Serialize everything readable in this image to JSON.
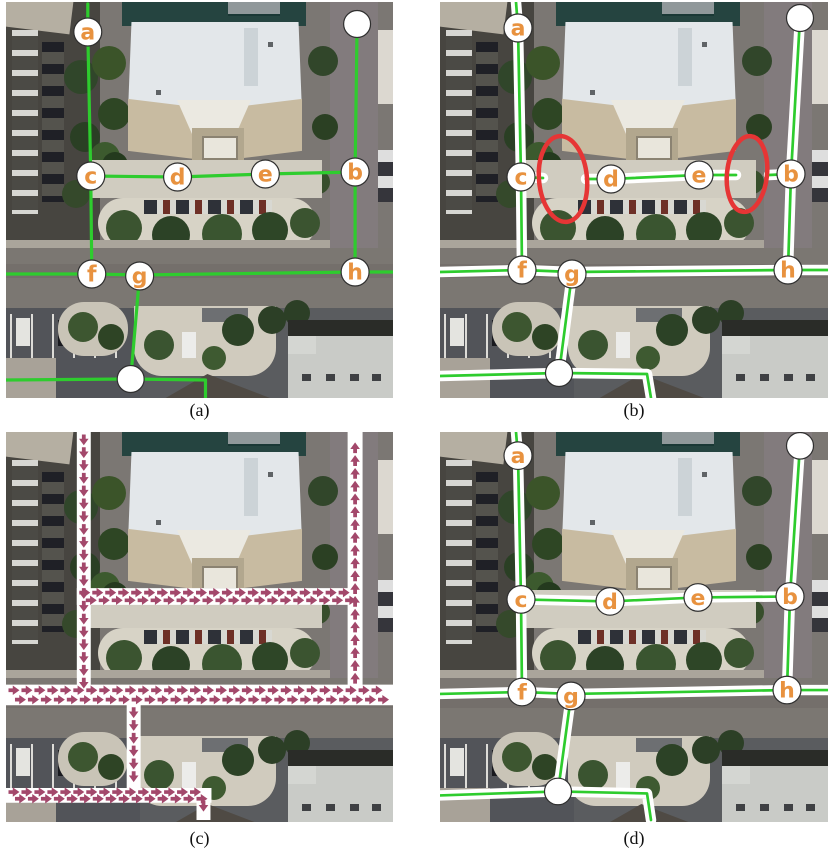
{
  "figure": {
    "background": "#ffffff",
    "panels": [
      {
        "id": "a",
        "caption": "(a)"
      },
      {
        "id": "b",
        "caption": "(b)"
      },
      {
        "id": "c",
        "caption": "(c)"
      },
      {
        "id": "d",
        "caption": "(d)"
      }
    ]
  },
  "colors": {
    "graph_green": "#2ecc2e",
    "node_label_orange": "#e8923f",
    "node_fill": "#ffffff",
    "node_outline": "#2f2f2f",
    "highlight_red": "#e63535",
    "arrow_maroon": "#a3486b",
    "band_white": "#ffffff",
    "caption_text": "#111111"
  },
  "graph": {
    "node_labels": [
      "a",
      "b",
      "c",
      "d",
      "e",
      "f",
      "g",
      "h"
    ],
    "panels": [
      {
        "id": "a",
        "style": "line",
        "edges": [
          [
            [
              82,
              2
            ],
            [
              82,
              30
            ],
            [
              85,
              174
            ]
          ],
          [
            [
              85,
              174
            ],
            [
              172,
              175
            ],
            [
              260,
              172
            ],
            [
              350,
              170
            ]
          ],
          [
            [
              352,
              22
            ],
            [
              350,
              170
            ],
            [
              350,
              270
            ]
          ],
          [
            [
              85,
              174
            ],
            [
              86,
              272
            ]
          ],
          [
            [
              0,
              272
            ],
            [
              86,
              272
            ],
            [
              134,
              273
            ],
            [
              350,
              270
            ],
            [
              388,
              270
            ]
          ],
          [
            [
              134,
              273
            ],
            [
              125,
              377
            ]
          ],
          [
            [
              0,
              378
            ],
            [
              125,
              377
            ],
            [
              200,
              378
            ],
            [
              200,
              396
            ]
          ]
        ],
        "nodes": [
          {
            "x": 82,
            "y": 30,
            "label": "a"
          },
          {
            "x": 352,
            "y": 22
          },
          {
            "x": 85,
            "y": 174,
            "label": "c"
          },
          {
            "x": 172,
            "y": 175,
            "label": "d"
          },
          {
            "x": 260,
            "y": 172,
            "label": "e"
          },
          {
            "x": 350,
            "y": 170,
            "label": "b"
          },
          {
            "x": 86,
            "y": 272,
            "label": "f"
          },
          {
            "x": 134,
            "y": 274,
            "label": "g"
          },
          {
            "x": 350,
            "y": 270,
            "label": "h"
          },
          {
            "x": 125,
            "y": 377
          }
        ]
      },
      {
        "id": "b",
        "style": "band",
        "edges": [
          [
            [
              76,
              0
            ],
            [
              78,
              26
            ],
            [
              81,
              175
            ],
            [
              82,
              268
            ]
          ],
          [
            [
              81,
              175
            ],
            [
              103,
              176
            ]
          ],
          [
            [
              146,
              177
            ],
            [
              171,
              177
            ],
            [
              259,
              173
            ],
            [
              296,
              173
            ]
          ],
          [
            [
              329,
              173
            ],
            [
              351,
              172
            ]
          ],
          [
            [
              360,
              16
            ],
            [
              351,
              172
            ],
            [
              348,
              268
            ]
          ],
          [
            [
              0,
              270
            ],
            [
              82,
              268
            ],
            [
              132,
              270
            ],
            [
              348,
              268
            ],
            [
              388,
              268
            ]
          ],
          [
            [
              132,
              272
            ],
            [
              119,
              371
            ]
          ],
          [
            [
              0,
              374
            ],
            [
              119,
              371
            ],
            [
              207,
              372
            ],
            [
              211,
              396
            ]
          ]
        ],
        "ellipses": [
          {
            "cx": 123,
            "cy": 177,
            "rx": 24,
            "ry": 43,
            "rot": -5
          },
          {
            "cx": 307,
            "cy": 172,
            "rx": 20,
            "ry": 38,
            "rot": 6
          }
        ],
        "nodes": [
          {
            "x": 78,
            "y": 26,
            "label": "a"
          },
          {
            "x": 360,
            "y": 16
          },
          {
            "x": 81,
            "y": 175,
            "label": "c"
          },
          {
            "x": 171,
            "y": 177,
            "label": "d"
          },
          {
            "x": 259,
            "y": 173,
            "label": "e"
          },
          {
            "x": 351,
            "y": 172,
            "label": "b"
          },
          {
            "x": 82,
            "y": 268,
            "label": "f"
          },
          {
            "x": 132,
            "y": 272,
            "label": "g"
          },
          {
            "x": 348,
            "y": 268,
            "label": "h"
          },
          {
            "x": 119,
            "y": 371
          }
        ]
      },
      {
        "id": "c",
        "style": "arrows",
        "bands": [
          {
            "x1": 78,
            "y1": 0,
            "x2": 78,
            "y2": 262,
            "w": 14,
            "rows": 1
          },
          {
            "x1": 71,
            "y1": 167,
            "x2": 352,
            "y2": 167,
            "w": 17,
            "rows": 2
          },
          {
            "x1": 350,
            "y1": 258,
            "x2": 350,
            "y2": 0,
            "w": 15,
            "rows": 1
          },
          {
            "x1": 0,
            "y1": 267,
            "x2": 388,
            "y2": 267,
            "w": 21,
            "rows": 2
          },
          {
            "x1": 128,
            "y1": 277,
            "x2": 128,
            "y2": 362,
            "w": 14,
            "rows": 1
          },
          {
            "x1": 0,
            "y1": 369,
            "x2": 206,
            "y2": 369,
            "w": 15,
            "rows": 2
          },
          {
            "x1": 198,
            "y1": 372,
            "x2": 198,
            "y2": 394,
            "w": 14,
            "rows": 1
          }
        ]
      },
      {
        "id": "d",
        "style": "band",
        "edges": [
          [
            [
              76,
              0
            ],
            [
              78,
              24
            ],
            [
              81,
              170
            ],
            [
              82,
              264
            ]
          ],
          [
            [
              81,
              170
            ],
            [
              170,
              172
            ],
            [
              258,
              168
            ],
            [
              350,
              167
            ]
          ],
          [
            [
              360,
              13
            ],
            [
              350,
              167
            ],
            [
              347,
              262
            ]
          ],
          [
            [
              0,
              266
            ],
            [
              82,
              264
            ],
            [
              131,
              266
            ],
            [
              347,
              262
            ],
            [
              388,
              262
            ]
          ],
          [
            [
              131,
              268
            ],
            [
              118,
              365
            ]
          ],
          [
            [
              0,
              369
            ],
            [
              118,
              365
            ],
            [
              207,
              367
            ],
            [
              211,
              394
            ]
          ]
        ],
        "nodes": [
          {
            "x": 78,
            "y": 24,
            "label": "a"
          },
          {
            "x": 360,
            "y": 14
          },
          {
            "x": 81,
            "y": 170,
            "label": "c"
          },
          {
            "x": 170,
            "y": 172,
            "label": "d"
          },
          {
            "x": 258,
            "y": 168,
            "label": "e"
          },
          {
            "x": 350,
            "y": 167,
            "label": "b"
          },
          {
            "x": 82,
            "y": 264,
            "label": "f"
          },
          {
            "x": 131,
            "y": 268,
            "label": "g"
          },
          {
            "x": 347,
            "y": 262,
            "label": "h"
          },
          {
            "x": 118,
            "y": 365
          }
        ]
      }
    ]
  }
}
